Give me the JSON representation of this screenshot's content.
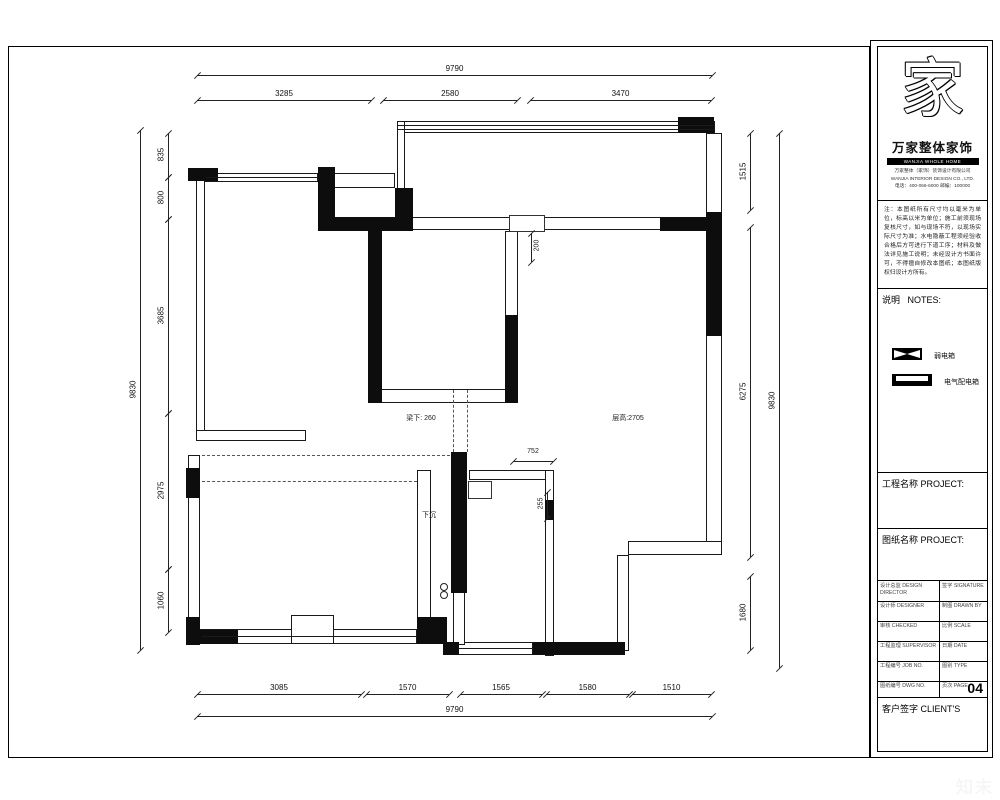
{
  "page": {
    "watermark": "知末",
    "page_number": "04"
  },
  "title_block": {
    "logo_glyph": "家",
    "brand": "万家整体家饰",
    "brand_en": "WANJIA WHOLE HOME FURNISHING",
    "address_lines": [
      "万家整体（家饰）装饰设计有限公司",
      "WANJIA INTERIOR DESIGN CO., LTD.",
      "电话：400-066-6000  邮编：100000"
    ],
    "notes_text": "注：本图纸所有尺寸均以毫米为单位，标高以米为单位；施工前须现场复核尺寸，如与现场不符，以现场实际尺寸为准；水电隐蔽工程须经验收合格后方可进行下道工序；材料及做法详见施工说明；未经设计方书面许可，不得擅自修改本图纸；本图纸版权归设计方所有。",
    "notes_header_cn": "说明",
    "notes_header_en": "NOTES:",
    "legend": [
      {
        "name": "weak-current-box",
        "label": "弱电箱"
      },
      {
        "name": "power-distribution-box",
        "label": "电气配电箱"
      }
    ],
    "project_label_cn": "工程名称",
    "project_label_en": "PROJECT:",
    "drawing_label_cn": "图纸名称",
    "drawing_label_en": "PROJECT:",
    "table_rows": [
      {
        "l": "设计总监 DESIGN DIRECTOR",
        "r": "签字 SIGNATURE"
      },
      {
        "l": "设计师 DESIGNER",
        "r": "制图 DRAWN BY"
      },
      {
        "l": "审核 CHECKED",
        "r": "比例 SCALE"
      },
      {
        "l": "工程监理 SUPERVISOR",
        "r": "日期 DATE"
      },
      {
        "l": "工程编号 JOB NO.",
        "r": "图别 TYPE"
      },
      {
        "l": "图纸编号 DWG NO.",
        "r": "页次 PAGE"
      }
    ],
    "client_label_cn": "客户签字",
    "client_label_en": "CLIENT'S"
  },
  "plan": {
    "annotations": [
      {
        "id": "beam-height",
        "text": "梁下: 260",
        "x": 421,
        "y": 418,
        "rot": 0
      },
      {
        "id": "ceiling-height",
        "text": "层高:2705",
        "x": 628,
        "y": 418,
        "rot": 0
      },
      {
        "id": "dim-200",
        "text": "200",
        "x": 537,
        "y": 247,
        "rot": 90
      },
      {
        "id": "dim-752",
        "text": "752",
        "x": 533,
        "y": 453,
        "rot": 0
      },
      {
        "id": "dim-255",
        "text": "255",
        "x": 541,
        "y": 505,
        "rot": 90
      },
      {
        "id": "sunken-area",
        "text": "下沉",
        "x": 429,
        "y": 515,
        "rot": 0
      }
    ],
    "dims": {
      "top_overall": {
        "label": "9790"
      },
      "top_segments": [
        {
          "label": "3285"
        },
        {
          "label": "2580"
        },
        {
          "label": "3470"
        }
      ],
      "left_overall": {
        "label": "9830"
      },
      "left_segments": [
        {
          "label": "835"
        },
        {
          "label": "800"
        },
        {
          "label": "3685"
        },
        {
          "label": "2975"
        },
        {
          "label": "1060"
        }
      ],
      "right_overall": {
        "label": "9830"
      },
      "right_segments": [
        {
          "label": "1515"
        },
        {
          "label": "6275"
        },
        {
          "label": "1680"
        }
      ],
      "bottom_overall": {
        "label": "9790"
      },
      "bottom_segments": [
        {
          "label": "3085"
        },
        {
          "label": "1570"
        },
        {
          "label": "1565"
        },
        {
          "label": "1580"
        },
        {
          "label": "1510"
        }
      ]
    }
  }
}
